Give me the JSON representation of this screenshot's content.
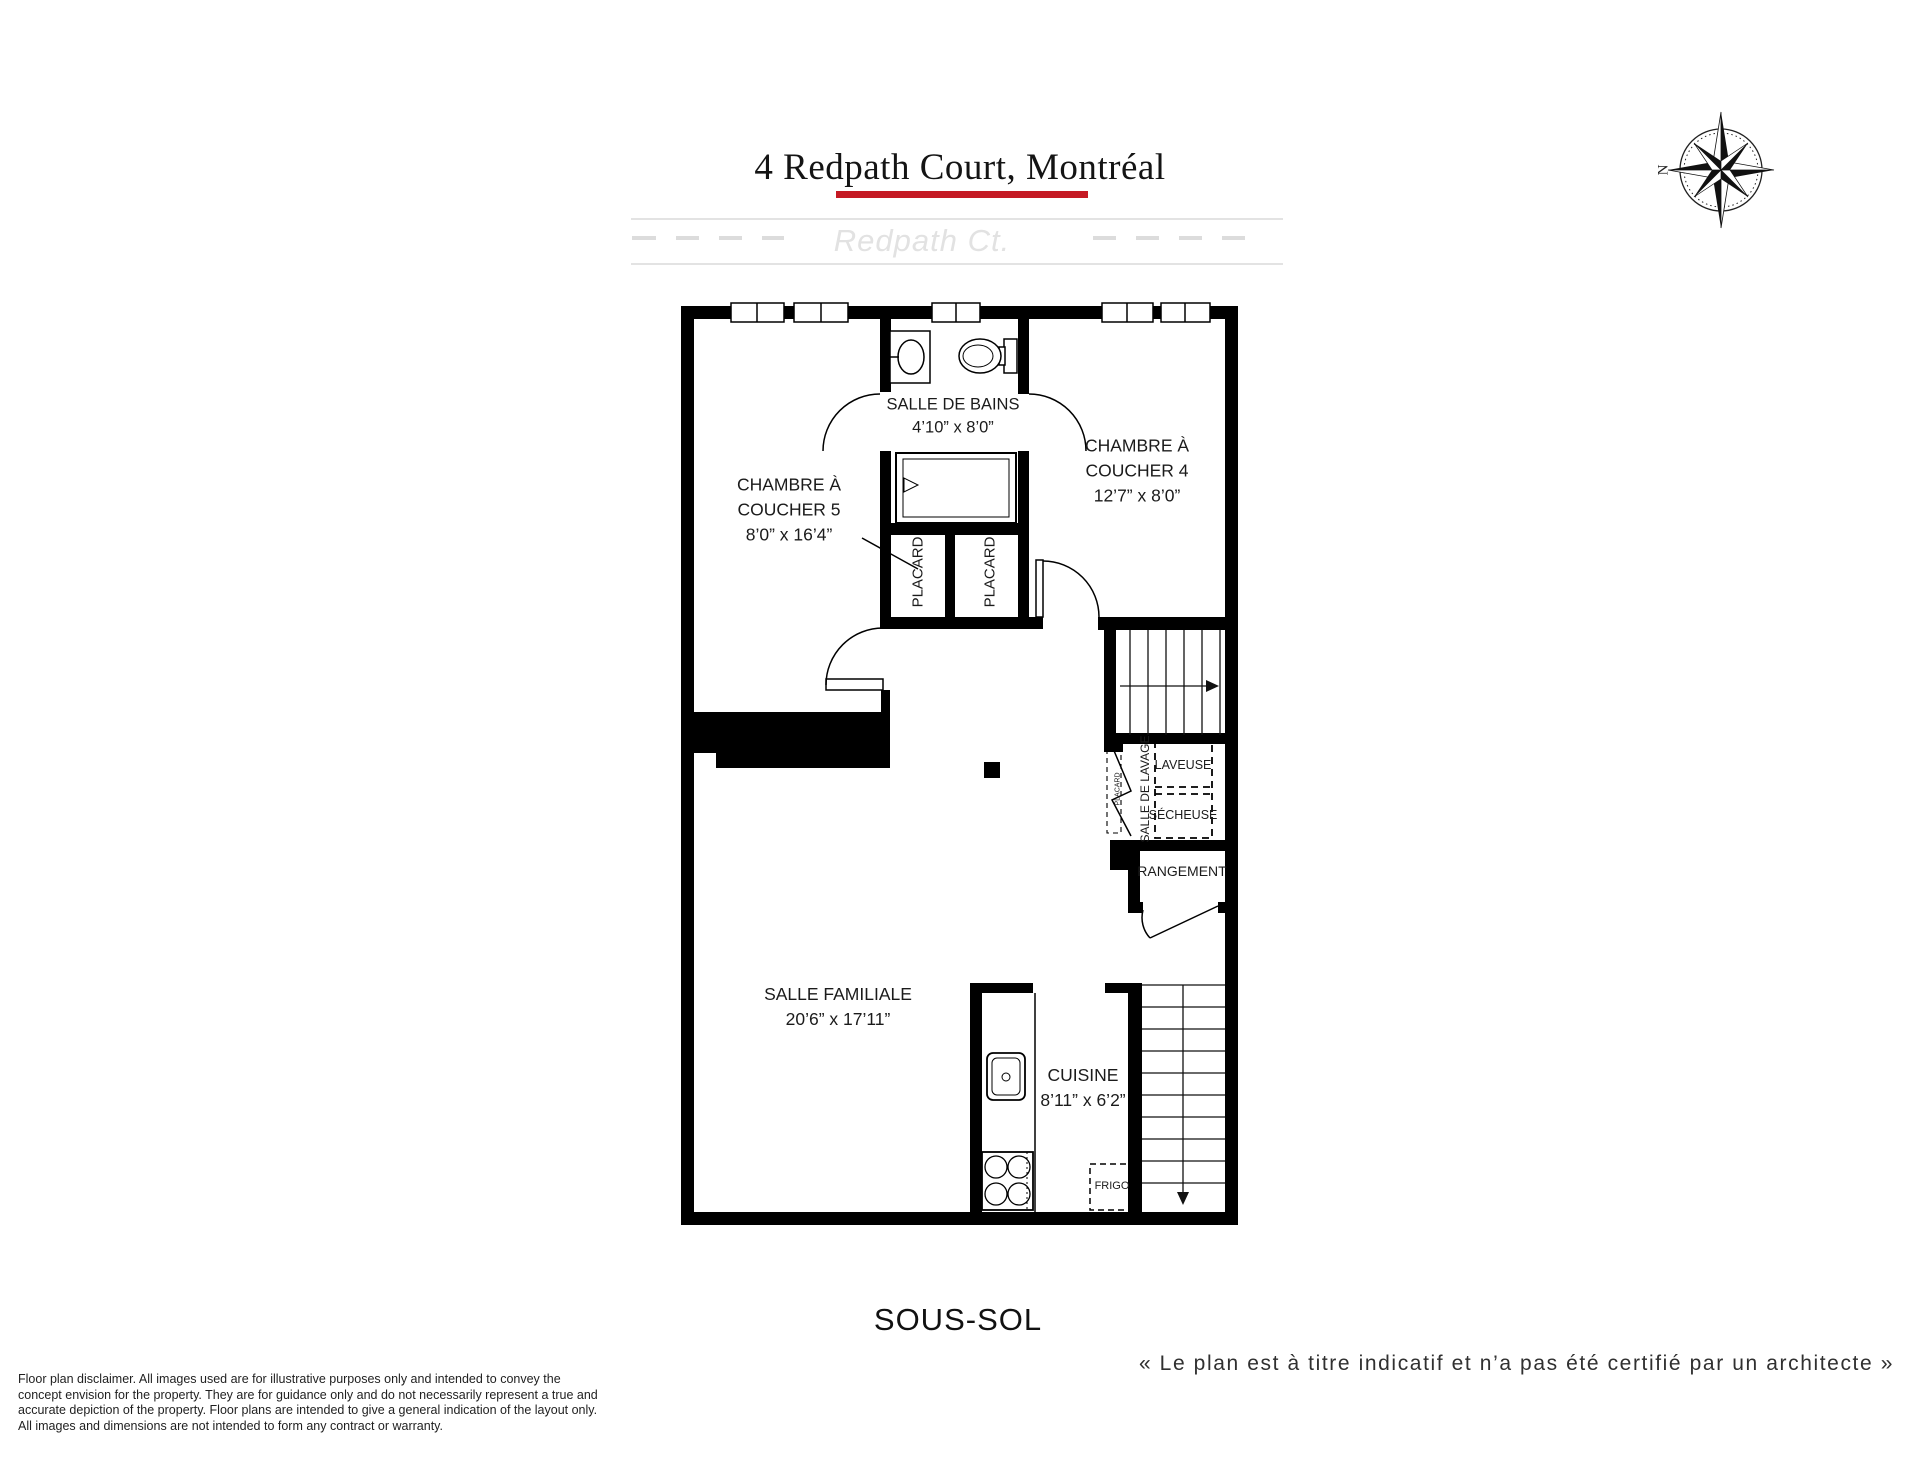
{
  "header": {
    "title": "4 Redpath Court, Montréal",
    "street_label": "Redpath Ct.",
    "underline_color": "#c51a24"
  },
  "compass": {
    "north_label": "N"
  },
  "rooms": {
    "bathroom": {
      "name": "SALLE DE BAINS",
      "dims": "4’10” x 8’0”"
    },
    "bedroom5": {
      "name_line1": "CHAMBRE À",
      "name_line2": "COUCHER 5",
      "dims": "8’0” x 16’4”"
    },
    "bedroom4": {
      "name_line1": "CHAMBRE À",
      "name_line2": "COUCHER 4",
      "dims": "12’7” x 8’0”"
    },
    "closet_left": {
      "name": "PLACARD"
    },
    "closet_right": {
      "name": "PLACARD"
    },
    "laundry": {
      "name": "SALLE DE LAVAGE",
      "washer": "LAVEUSE",
      "dryer": "SÉCHEUSE",
      "small_closet": "PLACARD"
    },
    "storage": {
      "name": "RANGEMENT"
    },
    "family": {
      "name": "SALLE FAMILIALE",
      "dims": "20’6” x 17’11”"
    },
    "kitchen": {
      "name": "CUISINE",
      "dims": "8’11” x 6’2”",
      "fridge": "FRIGO"
    }
  },
  "floor": {
    "label": "SOUS-SOL"
  },
  "footer": {
    "disclaimer": "Floor plan disclaimer. All images used are for illustrative purposes only and intended to convey the\nconcept envision for the property. They are for guidance only and do not necessarily represent a true and\naccurate depiction of the property. Floor plans are intended to give a general indication of the layout only.\nAll images and dimensions are not intended to form any contract or warranty.",
    "architect_note": "« Le plan est à titre indicatif et n’a pas été certifié par un architecte »"
  }
}
